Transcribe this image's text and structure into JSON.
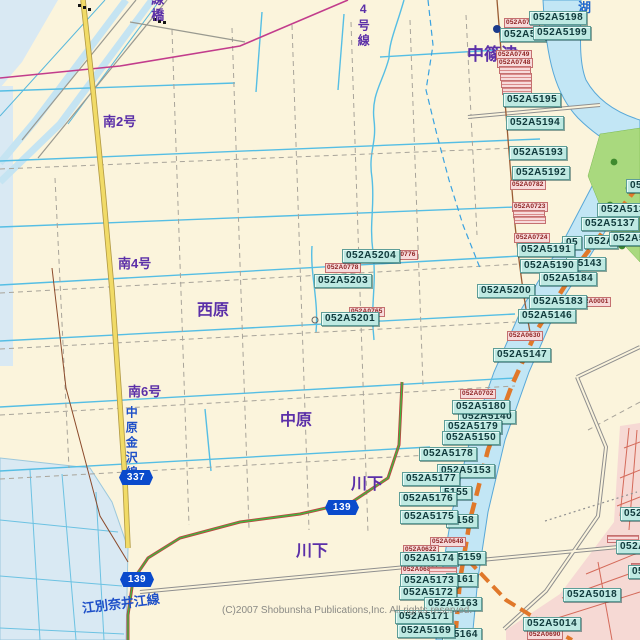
{
  "map": {
    "copyright": {
      "text": "(C)2007 Shobunsha Publications,Inc.  All rights reserved.",
      "x": 222,
      "y": 605
    },
    "names": [
      {
        "text": "中篠津",
        "x": 467,
        "y": 46,
        "size": 17
      },
      {
        "text": "西原",
        "x": 197,
        "y": 302,
        "size": 16
      },
      {
        "text": "中原",
        "x": 280,
        "y": 412,
        "size": 16
      },
      {
        "text": "川下",
        "x": 351,
        "y": 476,
        "size": 16
      },
      {
        "text": "川下",
        "x": 296,
        "y": 543,
        "size": 16
      },
      {
        "text": "南2号",
        "x": 103,
        "y": 115,
        "size": 13
      },
      {
        "text": "南4号",
        "x": 118,
        "y": 257,
        "size": 13
      },
      {
        "text": "南6号",
        "x": 128,
        "y": 385,
        "size": 13
      },
      {
        "text": "線橋",
        "x": 149,
        "y": -8,
        "size": 13,
        "cls": "vtext"
      },
      {
        "text": "4号線",
        "x": 356,
        "y": 2,
        "size": 12,
        "cls": "vtext"
      },
      {
        "text": "湖",
        "x": 578,
        "y": 1,
        "size": 13,
        "color": "#1F66CC"
      },
      {
        "text": "中原金沢線",
        "x": 124,
        "y": 406,
        "size": 12,
        "color": "#1F50C8",
        "cls": "vtext"
      },
      {
        "text": "江別奈井江線",
        "x": 82,
        "y": 597,
        "size": 13,
        "color": "#1F50C8",
        "rot": -7
      }
    ],
    "shields": [
      {
        "text": "337",
        "x": 119,
        "y": 470
      },
      {
        "text": "139",
        "x": 325,
        "y": 500
      },
      {
        "text": "139",
        "x": 120,
        "y": 572
      }
    ],
    "labels_cyan": [
      {
        "text": "052A51",
        "x": 500,
        "y": 28
      },
      {
        "text": "052A5198",
        "x": 529,
        "y": 11
      },
      {
        "text": "052A5199",
        "x": 533,
        "y": 26
      },
      {
        "text": "052A5195",
        "x": 503,
        "y": 93
      },
      {
        "text": "052A5194",
        "x": 506,
        "y": 116
      },
      {
        "text": "052A5193",
        "x": 509,
        "y": 146
      },
      {
        "text": "052A5192",
        "x": 512,
        "y": 166
      },
      {
        "text": "052A513",
        "x": 597,
        "y": 203
      },
      {
        "text": "052A5137",
        "x": 581,
        "y": 217
      },
      {
        "text": "05",
        "x": 562,
        "y": 236
      },
      {
        "text": "052A",
        "x": 584,
        "y": 235
      },
      {
        "text": "052A51",
        "x": 609,
        "y": 232
      },
      {
        "text": "052A5191",
        "x": 517,
        "y": 243
      },
      {
        "text": "A5143",
        "x": 566,
        "y": 257
      },
      {
        "text": "052A5190",
        "x": 520,
        "y": 259
      },
      {
        "text": "052A5184",
        "x": 539,
        "y": 272
      },
      {
        "text": "052A5200",
        "x": 477,
        "y": 284
      },
      {
        "text": "052A5183",
        "x": 529,
        "y": 295
      },
      {
        "text": "052A5146",
        "x": 518,
        "y": 309
      },
      {
        "text": "052A5147",
        "x": 493,
        "y": 348
      },
      {
        "text": "052A5204",
        "x": 342,
        "y": 249
      },
      {
        "text": "052A5203",
        "x": 314,
        "y": 274
      },
      {
        "text": "052A5201",
        "x": 321,
        "y": 312
      },
      {
        "text": "052A5140",
        "x": 458,
        "y": 410
      },
      {
        "text": "052A5180",
        "x": 452,
        "y": 400
      },
      {
        "text": "052A5179",
        "x": 444,
        "y": 420
      },
      {
        "text": "052A5150",
        "x": 442,
        "y": 431
      },
      {
        "text": "052A5178",
        "x": 419,
        "y": 447
      },
      {
        "text": "052A5153",
        "x": 437,
        "y": 464
      },
      {
        "text": "5155",
        "x": 440,
        "y": 486
      },
      {
        "text": "052A5177",
        "x": 402,
        "y": 472
      },
      {
        "text": "052A5176",
        "x": 399,
        "y": 492
      },
      {
        "text": "5158",
        "x": 446,
        "y": 514
      },
      {
        "text": "052A5175",
        "x": 400,
        "y": 510
      },
      {
        "text": "A5159",
        "x": 446,
        "y": 551
      },
      {
        "text": "052A5174",
        "x": 400,
        "y": 552
      },
      {
        "text": "5161",
        "x": 446,
        "y": 573
      },
      {
        "text": "052A5173",
        "x": 400,
        "y": 574
      },
      {
        "text": "052A5172",
        "x": 399,
        "y": 586
      },
      {
        "text": "052A5163",
        "x": 424,
        "y": 597
      },
      {
        "text": "052A5171",
        "x": 395,
        "y": 610
      },
      {
        "text": "A5164",
        "x": 442,
        "y": 628
      },
      {
        "text": "052A5169",
        "x": 397,
        "y": 624
      },
      {
        "text": "052A5018",
        "x": 563,
        "y": 588
      },
      {
        "text": "052A5014",
        "x": 523,
        "y": 617
      },
      {
        "text": "052A50",
        "x": 620,
        "y": 507
      },
      {
        "text": "052A50",
        "x": 616,
        "y": 540
      },
      {
        "text": "052A5",
        "x": 628,
        "y": 565
      },
      {
        "text": "052",
        "x": 626,
        "y": 179
      }
    ],
    "labels_pink": [
      {
        "text": "052A0751",
        "x": 504,
        "y": 18
      },
      {
        "text": "052A0749",
        "x": 496,
        "y": 50
      },
      {
        "text": "052A0748",
        "x": 497,
        "y": 58
      },
      {
        "cls": "pstripe",
        "x": 499,
        "y": 66,
        "w": 30
      },
      {
        "cls": "pstripe",
        "x": 500,
        "y": 73,
        "w": 30
      },
      {
        "cls": "pstripe",
        "x": 501,
        "y": 80,
        "w": 29
      },
      {
        "cls": "pstripe",
        "x": 502,
        "y": 87,
        "w": 28
      },
      {
        "text": "052A0782",
        "x": 510,
        "y": 180
      },
      {
        "text": "052A0723",
        "x": 512,
        "y": 202
      },
      {
        "cls": "pstripe",
        "x": 513,
        "y": 210,
        "w": 30
      },
      {
        "cls": "pstripe",
        "x": 514,
        "y": 216,
        "w": 30
      },
      {
        "text": "052A0724",
        "x": 514,
        "y": 233
      },
      {
        "text": "052A0776",
        "x": 382,
        "y": 250
      },
      {
        "text": "052A0778",
        "x": 325,
        "y": 263
      },
      {
        "text": "052A0765",
        "x": 349,
        "y": 307
      },
      {
        "text": "052A0001",
        "x": 575,
        "y": 297
      },
      {
        "text": "052A0630",
        "x": 507,
        "y": 331
      },
      {
        "text": "052A0702",
        "x": 460,
        "y": 389
      },
      {
        "text": "052A0648",
        "x": 430,
        "y": 537
      },
      {
        "text": "052A0622",
        "x": 403,
        "y": 545
      },
      {
        "text": "052A0682",
        "x": 401,
        "y": 565
      },
      {
        "cls": "pstripe",
        "x": 429,
        "y": 567,
        "w": 26
      },
      {
        "text": "052A0690",
        "x": 527,
        "y": 630
      },
      {
        "cls": "pstripe",
        "x": 607,
        "y": 535,
        "w": 30
      },
      {
        "cls": "pstripe",
        "x": 631,
        "y": 563,
        "w": 10
      }
    ]
  }
}
